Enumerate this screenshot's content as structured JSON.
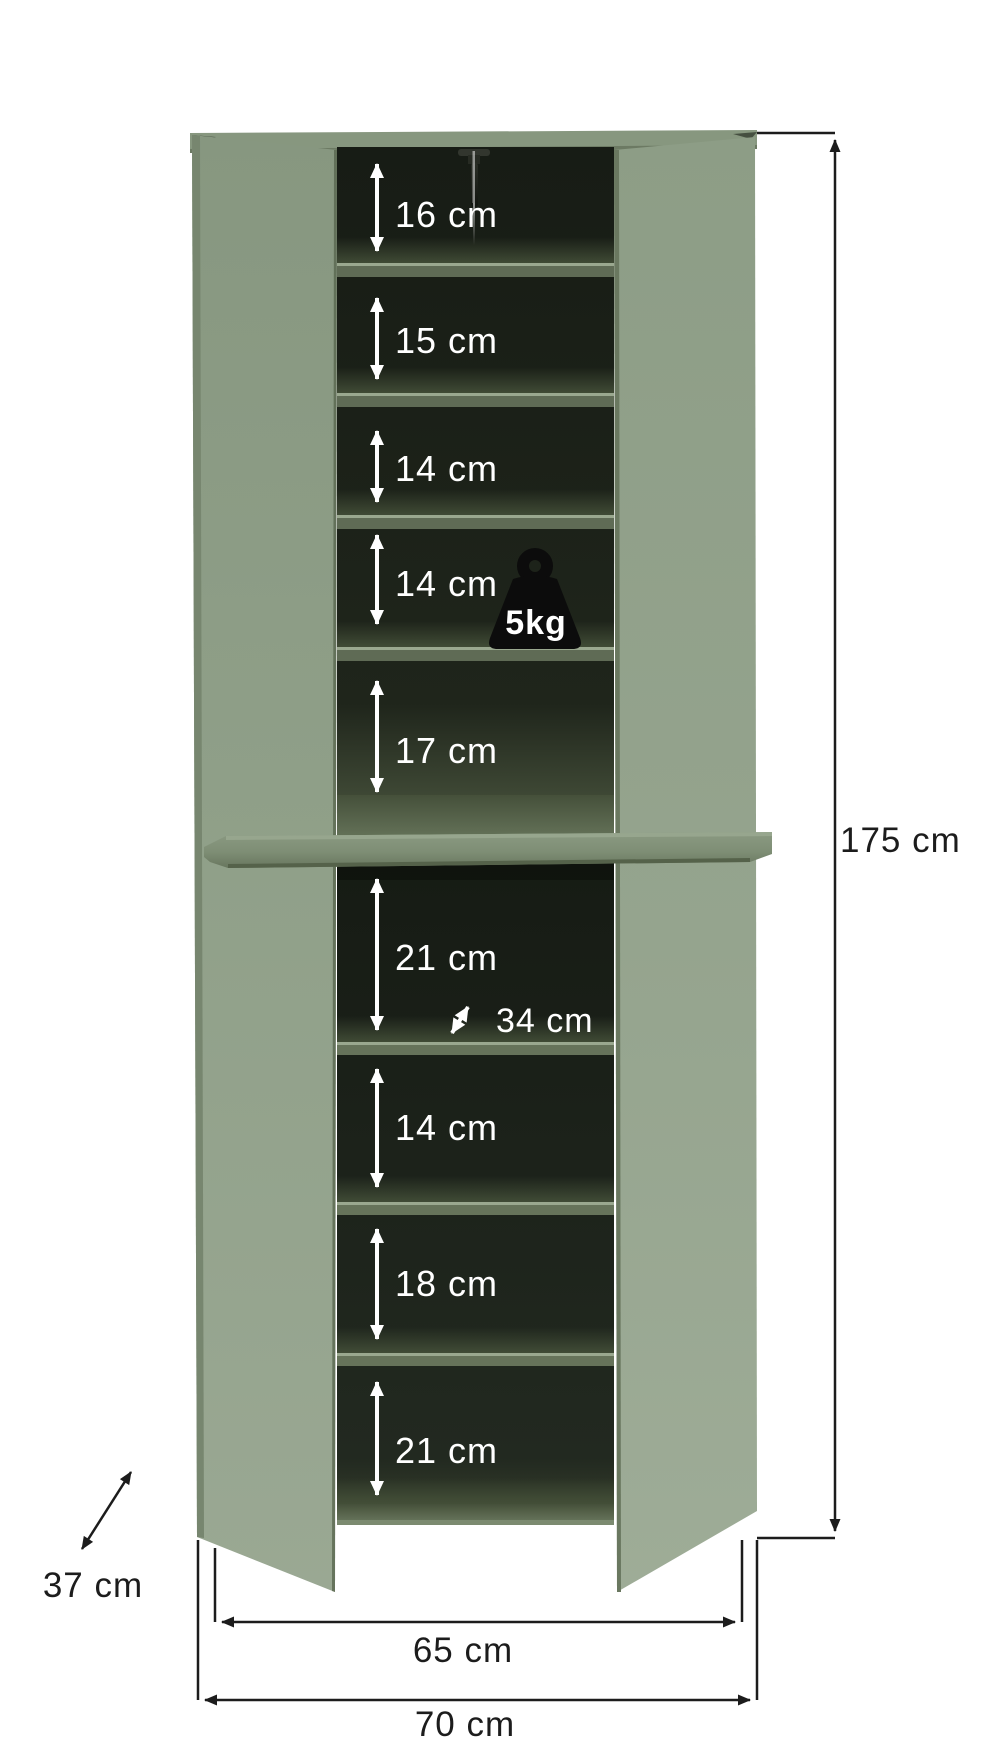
{
  "diagram_type": "furniture-dimension-drawing",
  "colors": {
    "door_green": "#8f9f88",
    "door_green_dark": "#77866f",
    "top_band_green": "#87977f",
    "interior_dark": "#1d2219",
    "shelf_green": "#5f6b55",
    "shelf_highlight": "#9aa88f",
    "divider_green": "#7e8e75",
    "dim_line_black": "#1c1c1c",
    "arrow_white": "#ffffff",
    "weight_black": "#0c0c0c",
    "background": "#ffffff"
  },
  "cabinet": {
    "description": "tall two-door cabinet shown with both doors open",
    "load_badge": "5kg",
    "top_sections": [
      {
        "label": "16 cm"
      },
      {
        "label": "15 cm"
      },
      {
        "label": "14 cm"
      },
      {
        "label": "14 cm"
      },
      {
        "label": "17 cm"
      }
    ],
    "bottom_sections": [
      {
        "label": "21 cm"
      },
      {
        "label": "14 cm"
      },
      {
        "label": "18 cm"
      },
      {
        "label": "21 cm"
      }
    ],
    "shelf_depth": "34 cm"
  },
  "dimensions": {
    "total_height": "175 cm",
    "depth": "37 cm",
    "inner_width": "65 cm",
    "outer_width": "70 cm"
  }
}
